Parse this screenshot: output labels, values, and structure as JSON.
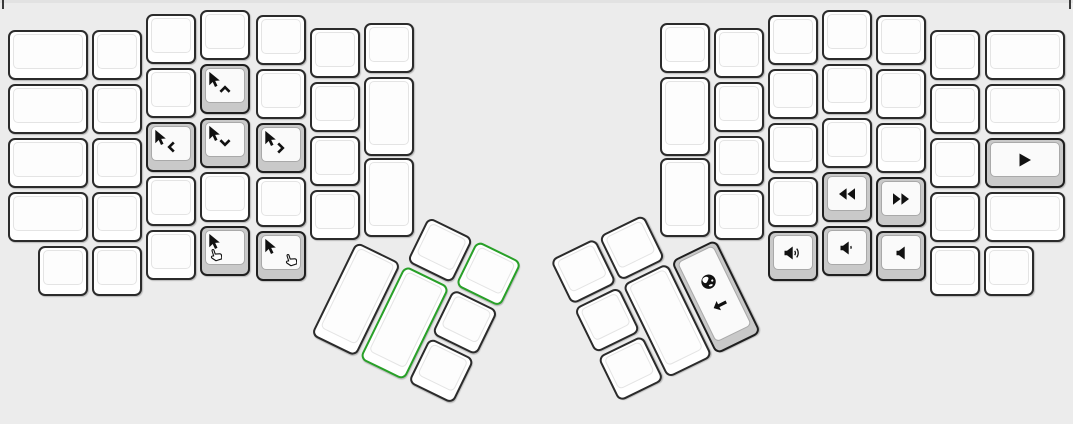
{
  "window": {
    "width": 1073,
    "height": 424
  },
  "colors": {
    "background": "#ececec",
    "top_strip": "#e2e2e2",
    "panel_edge": "#3a3a3a",
    "key_border": "#2b2b2b",
    "key_fill": "#ffffff",
    "configured_fill": "#c9c9c9",
    "highlight_green": "#28a028",
    "icon": "#111111"
  },
  "keyboard": {
    "left_main": {
      "keys": [
        {
          "name": "blank-key",
          "x": 8,
          "y": 30,
          "w": 80,
          "h": 50
        },
        {
          "name": "blank-key",
          "x": 8,
          "y": 84,
          "w": 80,
          "h": 50
        },
        {
          "name": "blank-key",
          "x": 8,
          "y": 138,
          "w": 80,
          "h": 50
        },
        {
          "name": "blank-key",
          "x": 8,
          "y": 192,
          "w": 80,
          "h": 50
        },
        {
          "name": "blank-key",
          "x": 92,
          "y": 30,
          "w": 50,
          "h": 50
        },
        {
          "name": "blank-key",
          "x": 92,
          "y": 84,
          "w": 50,
          "h": 50
        },
        {
          "name": "blank-key",
          "x": 92,
          "y": 138,
          "w": 50,
          "h": 50
        },
        {
          "name": "blank-key",
          "x": 92,
          "y": 192,
          "w": 50,
          "h": 50
        },
        {
          "name": "blank-key",
          "x": 146,
          "y": 14,
          "w": 50,
          "h": 50
        },
        {
          "name": "blank-key",
          "x": 146,
          "y": 68,
          "w": 50,
          "h": 50
        },
        {
          "name": "mouse-left-key",
          "x": 146,
          "y": 122,
          "w": 50,
          "h": 50,
          "variant": "configured",
          "glyphs": [
            {
              "icon": "cursor",
              "pos": "tl"
            },
            {
              "icon": "chevron-left",
              "pos": "mid"
            }
          ]
        },
        {
          "name": "blank-key",
          "x": 146,
          "y": 176,
          "w": 50,
          "h": 50
        },
        {
          "name": "blank-key",
          "x": 200,
          "y": 10,
          "w": 50,
          "h": 50
        },
        {
          "name": "mouse-up-key",
          "x": 200,
          "y": 64,
          "w": 50,
          "h": 50,
          "variant": "configured",
          "glyphs": [
            {
              "icon": "cursor",
              "pos": "tl"
            },
            {
              "icon": "chevron-up",
              "pos": "mid"
            }
          ]
        },
        {
          "name": "mouse-down-key",
          "x": 200,
          "y": 118,
          "w": 50,
          "h": 50,
          "variant": "configured",
          "glyphs": [
            {
              "icon": "cursor",
              "pos": "tl"
            },
            {
              "icon": "chevron-down",
              "pos": "mid"
            }
          ]
        },
        {
          "name": "blank-key",
          "x": 200,
          "y": 172,
          "w": 50,
          "h": 50
        },
        {
          "name": "blank-key",
          "x": 256,
          "y": 15,
          "w": 50,
          "h": 50
        },
        {
          "name": "blank-key",
          "x": 256,
          "y": 69,
          "w": 50,
          "h": 50
        },
        {
          "name": "mouse-right-key",
          "x": 256,
          "y": 123,
          "w": 50,
          "h": 50,
          "variant": "configured",
          "glyphs": [
            {
              "icon": "cursor",
              "pos": "tl"
            },
            {
              "icon": "chevron-right",
              "pos": "mid"
            }
          ]
        },
        {
          "name": "blank-key",
          "x": 256,
          "y": 177,
          "w": 50,
          "h": 50
        },
        {
          "name": "blank-key",
          "x": 310,
          "y": 28,
          "w": 50,
          "h": 50
        },
        {
          "name": "blank-key",
          "x": 310,
          "y": 82,
          "w": 50,
          "h": 50
        },
        {
          "name": "blank-key",
          "x": 310,
          "y": 136,
          "w": 50,
          "h": 50
        },
        {
          "name": "blank-key",
          "x": 310,
          "y": 190,
          "w": 50,
          "h": 50
        },
        {
          "name": "blank-key",
          "x": 364,
          "y": 23,
          "w": 50,
          "h": 50
        },
        {
          "name": "blank-key",
          "x": 364,
          "y": 77,
          "w": 50,
          "h": 79
        },
        {
          "name": "blank-key",
          "x": 364,
          "y": 158,
          "w": 50,
          "h": 79
        },
        {
          "name": "blank-key",
          "x": 38,
          "y": 246,
          "w": 50,
          "h": 50
        },
        {
          "name": "blank-key",
          "x": 92,
          "y": 246,
          "w": 50,
          "h": 50
        },
        {
          "name": "blank-key",
          "x": 146,
          "y": 230,
          "w": 50,
          "h": 50
        },
        {
          "name": "mouse-button1-key",
          "x": 200,
          "y": 226,
          "w": 50,
          "h": 50,
          "variant": "configured",
          "glyphs": [
            {
              "icon": "cursor",
              "pos": "tl"
            },
            {
              "icon": "hand",
              "pos": "bl"
            }
          ]
        },
        {
          "name": "mouse-button2-key",
          "x": 256,
          "y": 231,
          "w": 50,
          "h": 50,
          "variant": "configured",
          "glyphs": [
            {
              "icon": "cursor",
              "pos": "tl"
            },
            {
              "icon": "hand",
              "pos": "br"
            }
          ]
        }
      ]
    },
    "right_main": {
      "keys": [
        {
          "name": "blank-key",
          "x": 660,
          "y": 23,
          "w": 50,
          "h": 50
        },
        {
          "name": "blank-key",
          "x": 660,
          "y": 77,
          "w": 50,
          "h": 79
        },
        {
          "name": "blank-key",
          "x": 660,
          "y": 158,
          "w": 50,
          "h": 79
        },
        {
          "name": "blank-key",
          "x": 714,
          "y": 28,
          "w": 50,
          "h": 50
        },
        {
          "name": "blank-key",
          "x": 714,
          "y": 82,
          "w": 50,
          "h": 50
        },
        {
          "name": "blank-key",
          "x": 714,
          "y": 136,
          "w": 50,
          "h": 50
        },
        {
          "name": "blank-key",
          "x": 714,
          "y": 190,
          "w": 50,
          "h": 50
        },
        {
          "name": "blank-key",
          "x": 768,
          "y": 15,
          "w": 50,
          "h": 50
        },
        {
          "name": "blank-key",
          "x": 768,
          "y": 69,
          "w": 50,
          "h": 50
        },
        {
          "name": "blank-key",
          "x": 768,
          "y": 123,
          "w": 50,
          "h": 50
        },
        {
          "name": "blank-key",
          "x": 768,
          "y": 177,
          "w": 50,
          "h": 50
        },
        {
          "name": "volume-up-key",
          "x": 768,
          "y": 231,
          "w": 50,
          "h": 50,
          "variant": "configured",
          "glyphs": [
            {
              "icon": "volume-up",
              "pos": "center"
            }
          ]
        },
        {
          "name": "blank-key",
          "x": 822,
          "y": 10,
          "w": 50,
          "h": 50
        },
        {
          "name": "blank-key",
          "x": 822,
          "y": 64,
          "w": 50,
          "h": 50
        },
        {
          "name": "blank-key",
          "x": 822,
          "y": 118,
          "w": 50,
          "h": 50
        },
        {
          "name": "rewind-key",
          "x": 822,
          "y": 172,
          "w": 50,
          "h": 50,
          "variant": "configured",
          "glyphs": [
            {
              "icon": "rewind",
              "pos": "center"
            }
          ]
        },
        {
          "name": "volume-down-key",
          "x": 822,
          "y": 226,
          "w": 50,
          "h": 50,
          "variant": "configured",
          "glyphs": [
            {
              "icon": "volume-down",
              "pos": "center"
            }
          ]
        },
        {
          "name": "blank-key",
          "x": 876,
          "y": 15,
          "w": 50,
          "h": 50
        },
        {
          "name": "blank-key",
          "x": 876,
          "y": 69,
          "w": 50,
          "h": 50
        },
        {
          "name": "blank-key",
          "x": 876,
          "y": 123,
          "w": 50,
          "h": 50
        },
        {
          "name": "fast-forward-key",
          "x": 876,
          "y": 177,
          "w": 50,
          "h": 50,
          "variant": "configured",
          "glyphs": [
            {
              "icon": "fast-forward",
              "pos": "center"
            }
          ]
        },
        {
          "name": "mute-key",
          "x": 876,
          "y": 231,
          "w": 50,
          "h": 50,
          "variant": "configured",
          "glyphs": [
            {
              "icon": "mute",
              "pos": "center"
            }
          ]
        },
        {
          "name": "blank-key",
          "x": 930,
          "y": 30,
          "w": 50,
          "h": 50
        },
        {
          "name": "blank-key",
          "x": 930,
          "y": 84,
          "w": 50,
          "h": 50
        },
        {
          "name": "blank-key",
          "x": 930,
          "y": 138,
          "w": 50,
          "h": 50
        },
        {
          "name": "blank-key",
          "x": 930,
          "y": 192,
          "w": 50,
          "h": 50
        },
        {
          "name": "blank-key",
          "x": 930,
          "y": 246,
          "w": 50,
          "h": 50
        },
        {
          "name": "blank-key",
          "x": 984,
          "y": 246,
          "w": 50,
          "h": 50
        },
        {
          "name": "blank-key",
          "x": 985,
          "y": 30,
          "w": 80,
          "h": 50
        },
        {
          "name": "blank-key",
          "x": 985,
          "y": 84,
          "w": 80,
          "h": 50
        },
        {
          "name": "play-pause-key",
          "x": 985,
          "y": 138,
          "w": 80,
          "h": 50,
          "variant": "configured",
          "glyphs": [
            {
              "icon": "play",
              "pos": "center"
            }
          ]
        },
        {
          "name": "blank-key",
          "x": 985,
          "y": 192,
          "w": 80,
          "h": 50
        }
      ]
    },
    "left_thumb_cluster": {
      "x": 380,
      "y": 193,
      "rotation_deg": 26,
      "keys": [
        {
          "name": "blank-key",
          "x": 54,
          "y": 0,
          "w": 50,
          "h": 50
        },
        {
          "name": "highlighted-key",
          "x": 108,
          "y": 0,
          "w": 50,
          "h": 50,
          "variant": "highlight"
        },
        {
          "name": "blank-key",
          "x": 0,
          "y": 54,
          "w": 50,
          "h": 104
        },
        {
          "name": "highlighted-key",
          "x": 54,
          "y": 54,
          "w": 50,
          "h": 104,
          "variant": "highlight"
        },
        {
          "name": "blank-key",
          "x": 108,
          "y": 54,
          "w": 50,
          "h": 50
        },
        {
          "name": "blank-key",
          "x": 108,
          "y": 108,
          "w": 50,
          "h": 50
        }
      ]
    },
    "right_thumb_cluster": {
      "x": 550,
      "y": 260,
      "rotation_deg": -26,
      "keys": [
        {
          "name": "blank-key",
          "x": 0,
          "y": 0,
          "w": 50,
          "h": 50
        },
        {
          "name": "blank-key",
          "x": 54,
          "y": 0,
          "w": 50,
          "h": 50
        },
        {
          "name": "blank-key",
          "x": 0,
          "y": 54,
          "w": 50,
          "h": 50
        },
        {
          "name": "blank-key",
          "x": 0,
          "y": 108,
          "w": 50,
          "h": 50
        },
        {
          "name": "blank-key",
          "x": 54,
          "y": 54,
          "w": 50,
          "h": 104
        },
        {
          "name": "browser-back-key",
          "x": 108,
          "y": 54,
          "w": 50,
          "h": 104,
          "variant": "configured",
          "glyphs": [
            {
              "icon": "globe",
              "pos": "upper"
            },
            {
              "icon": "arrow-left",
              "pos": "lower"
            }
          ]
        }
      ]
    }
  }
}
